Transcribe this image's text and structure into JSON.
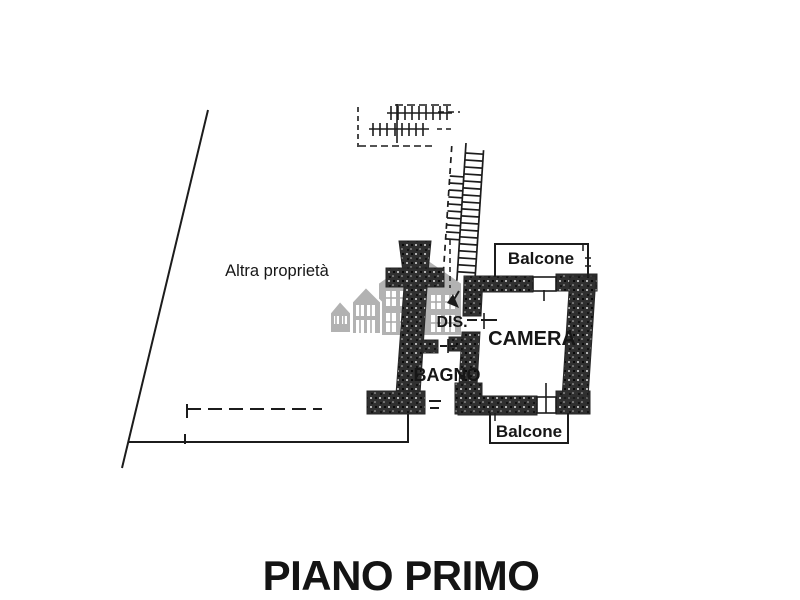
{
  "title": {
    "text": "PIANO PRIMO"
  },
  "labels": {
    "other_property": "Altra proprietà",
    "hallway": "DIS.",
    "bedroom": "CAMERA",
    "bathroom": "BAGNO",
    "balcony_top": "Balcone",
    "balcony_bottom": "Balcone"
  },
  "colors": {
    "background": "#ffffff",
    "line": "#1c1c1c",
    "wall": "#303030",
    "text": "#141414",
    "watermark": "#b2b2b2"
  },
  "watermark": {
    "icon": "houses-logo-icon"
  }
}
